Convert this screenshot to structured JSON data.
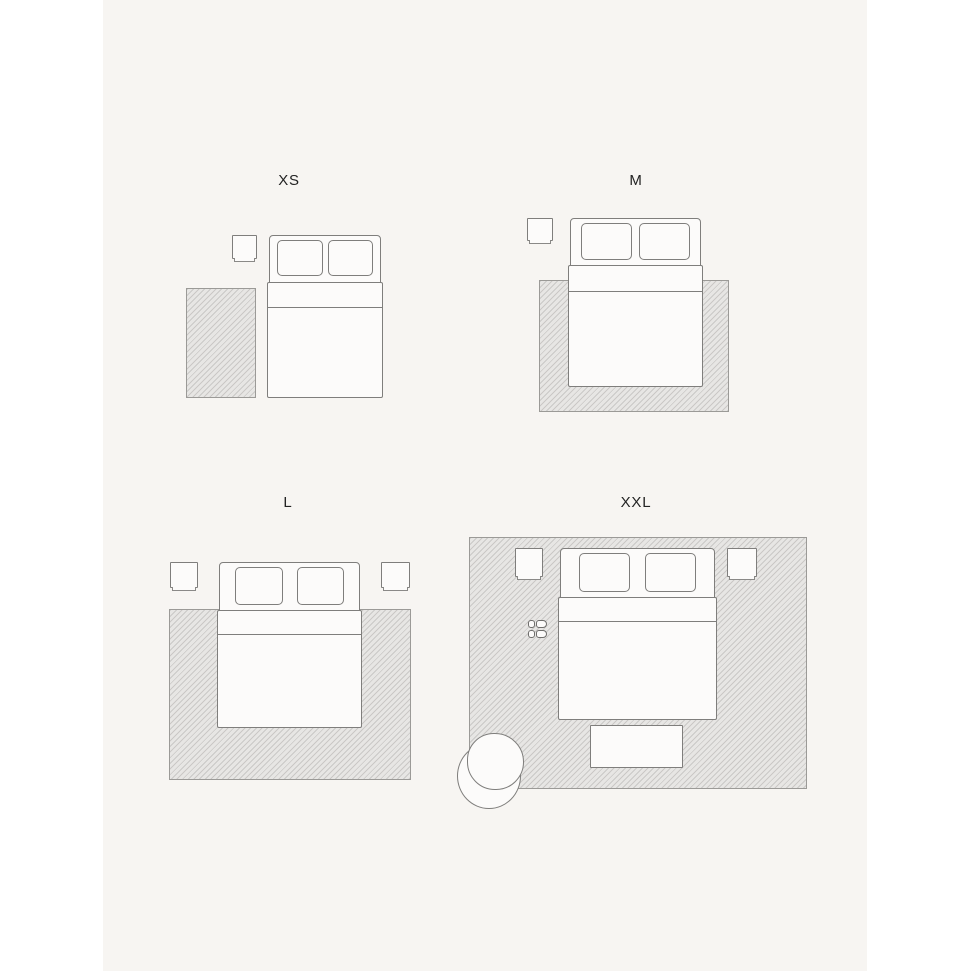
{
  "figure": {
    "type": "rug-size-guide",
    "description": "Top-down bedroom floor-plan illustrations comparing four rug sizes relative to a double bed",
    "page_background": "#ffffff",
    "panel_background": "#f7f5f2"
  },
  "colors": {
    "rug_fill": "#e7e6e4",
    "rug_hatch_line": "#b2b1ae",
    "rug_border": "#9b9a97",
    "furniture_fill": "#fcfbfa",
    "furniture_outline": "#7f7e7c",
    "label_text": "#232323"
  },
  "sizes": [
    {
      "id": "xs",
      "label": "XS",
      "elements": [
        "nightstand",
        "double-bed",
        "bedside-rug"
      ]
    },
    {
      "id": "m",
      "label": "M",
      "elements": [
        "nightstand",
        "double-bed",
        "rug-under-lower-half-of-bed"
      ]
    },
    {
      "id": "l",
      "label": "L",
      "elements": [
        "nightstand-left",
        "double-bed",
        "nightstand-right",
        "rug-under-lower-half-of-bed"
      ]
    },
    {
      "id": "xxl",
      "label": "XXL",
      "elements": [
        "room-size-rug",
        "nightstand-left",
        "double-bed",
        "nightstand-right",
        "slippers",
        "bench",
        "armchair"
      ]
    }
  ]
}
